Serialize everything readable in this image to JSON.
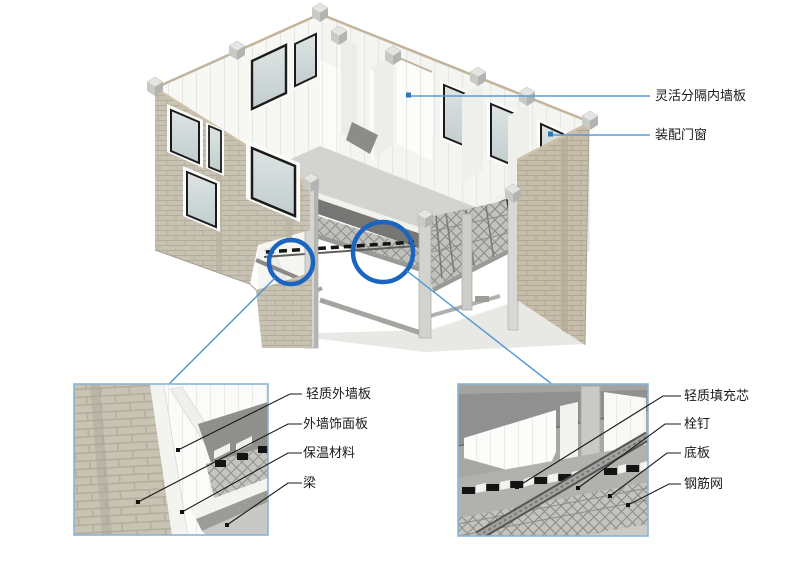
{
  "figure": {
    "main_callouts": [
      {
        "label": "灵活分隔内墙板"
      },
      {
        "label": "装配门窗"
      }
    ],
    "detail_left": {
      "labels": [
        {
          "text": "轻质外墙板"
        },
        {
          "text": "外墙饰面板"
        },
        {
          "text": "保温材料"
        },
        {
          "text": "梁"
        }
      ]
    },
    "detail_right": {
      "labels": [
        {
          "text": "轻质填充芯"
        },
        {
          "text": "栓钉"
        },
        {
          "text": "底板"
        },
        {
          "text": "钢筋网"
        }
      ]
    },
    "colors": {
      "callout_line": "#5b9bd5",
      "highlight_circle": "#1b64c0",
      "detail_box_border": "#8ab4d8",
      "leader_line": "#1a1a1a",
      "text": "#1a1a1a",
      "brick": "#c8c2b2",
      "panel_white": "#fbfbf9",
      "slab_gray": "#d3d3d0"
    }
  }
}
